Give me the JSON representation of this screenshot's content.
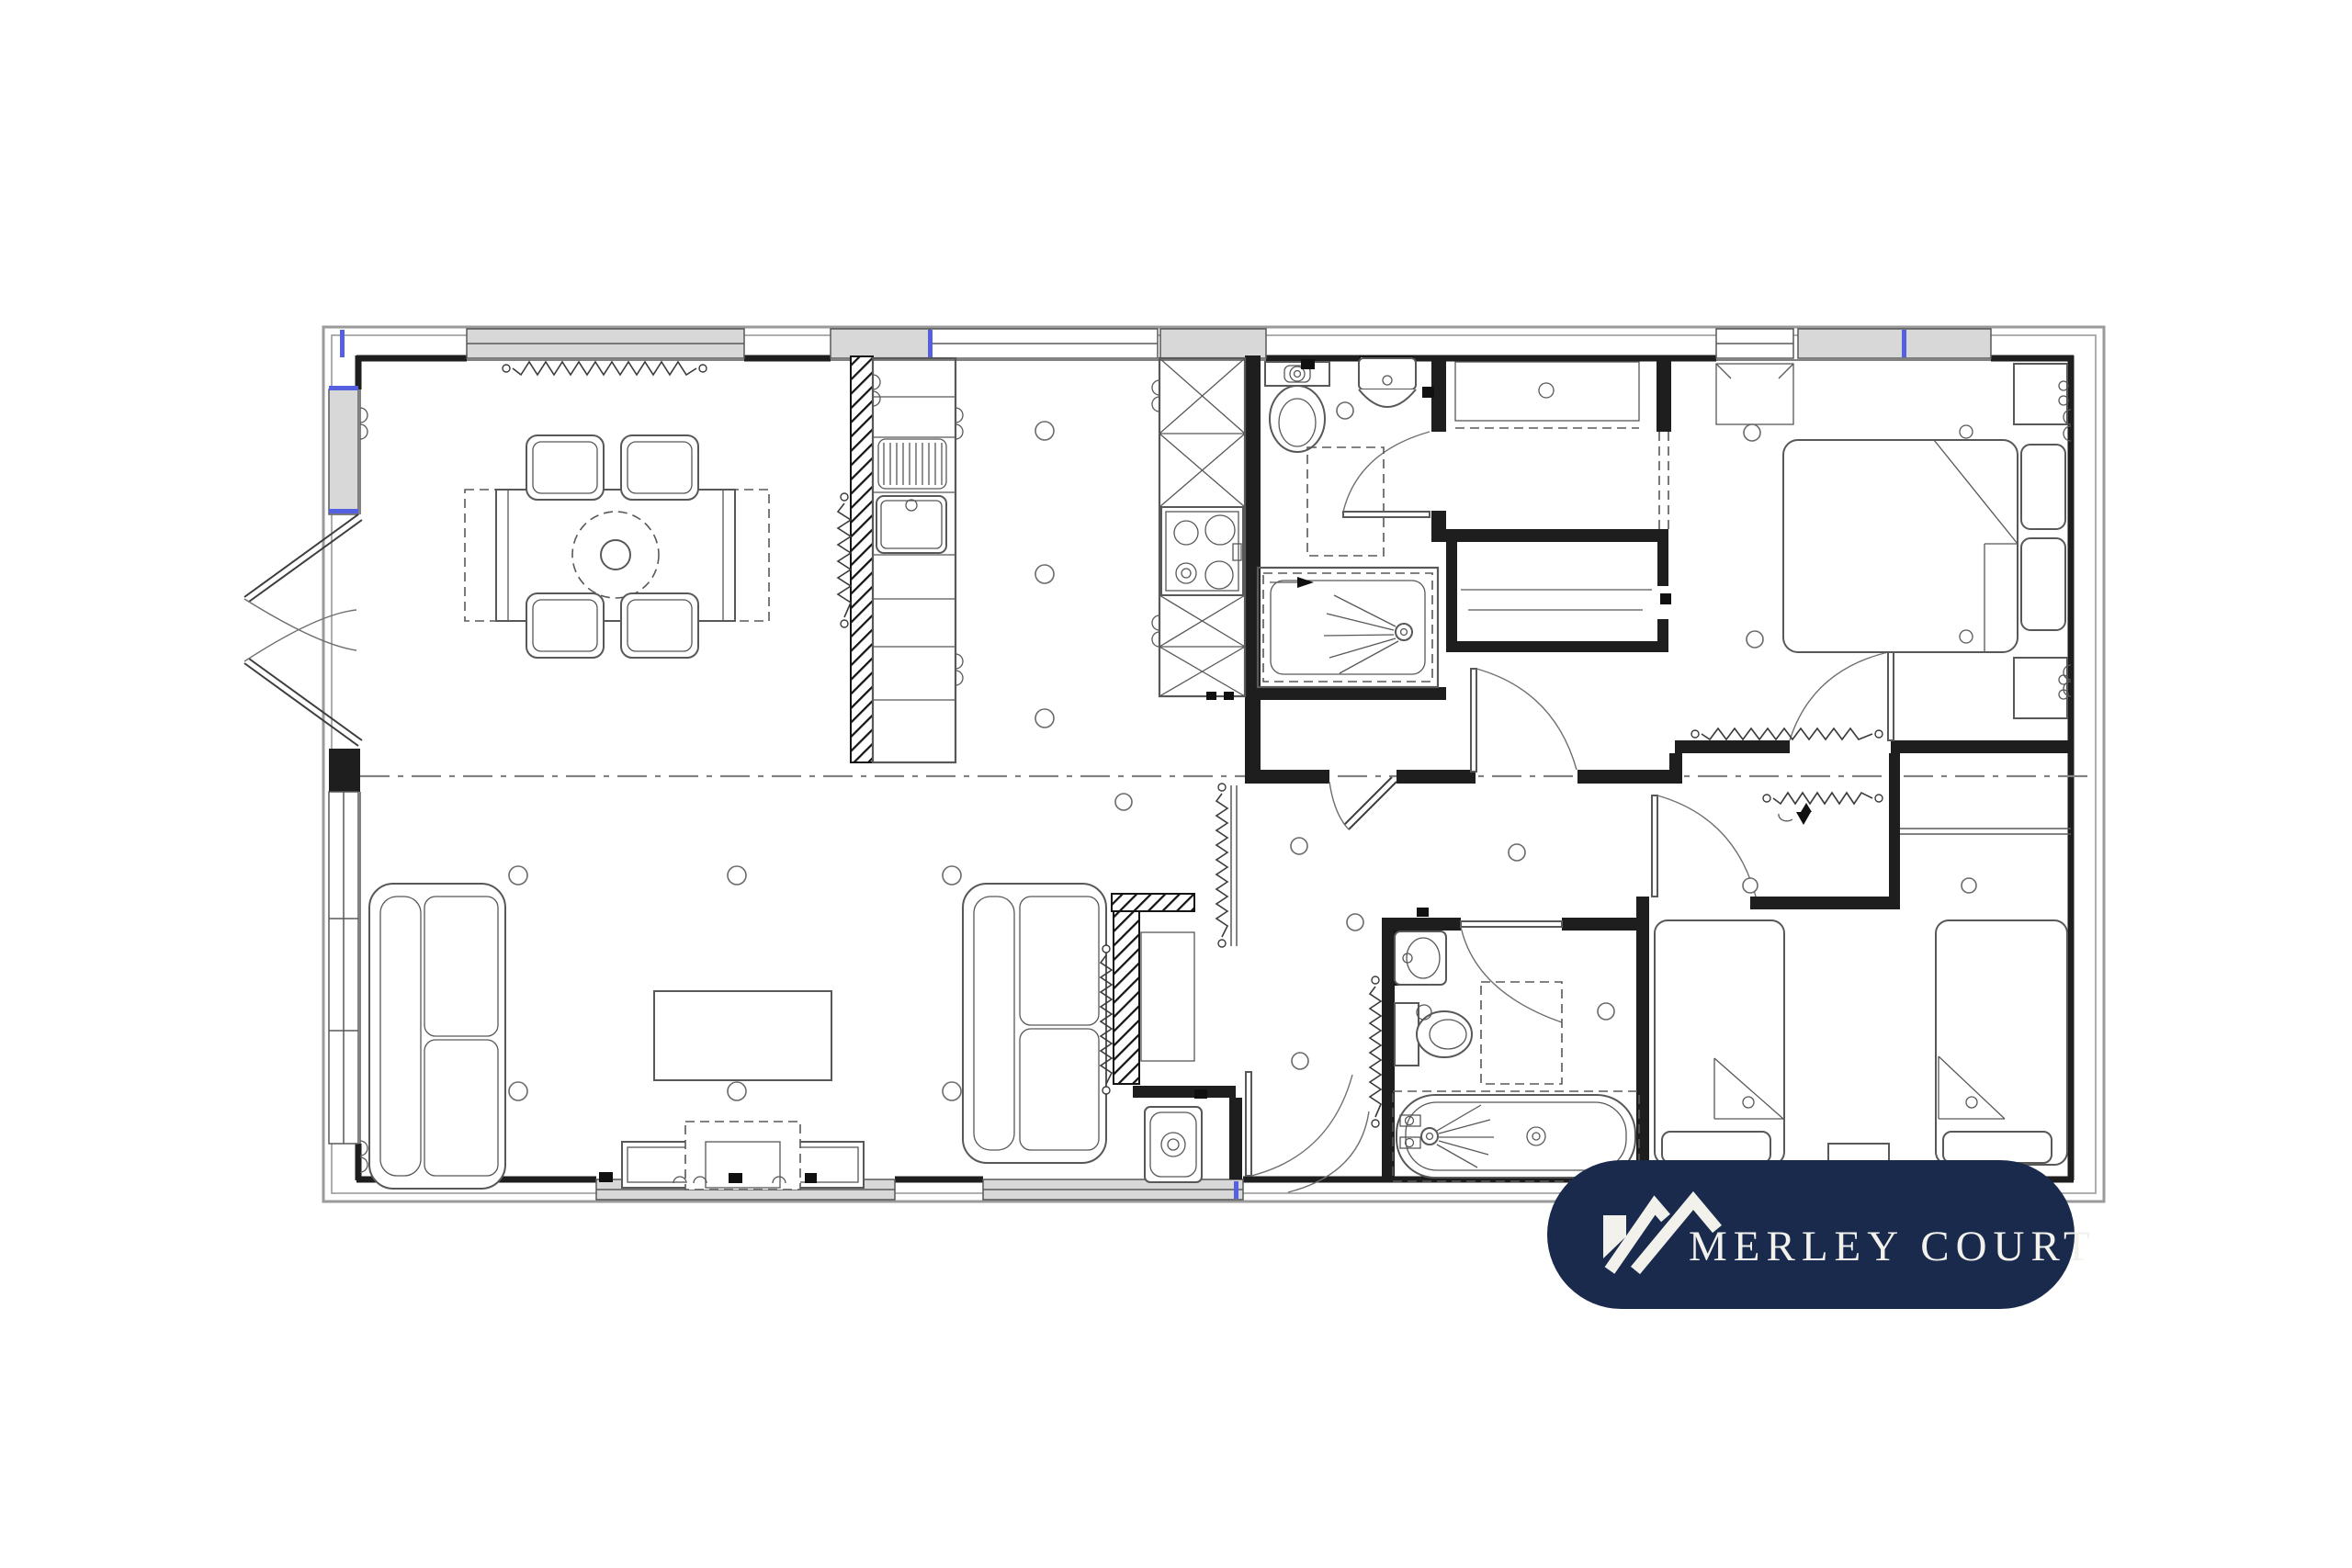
{
  "page": {
    "background": "#ffffff"
  },
  "palette": {
    "page_bg": "#ffffff",
    "wall": "#1e1e1e",
    "line": "#585858",
    "light_line": "#9a9a9a",
    "window_fill": "#d8d8d8",
    "dashdot": "#828282",
    "glazing_accent": "#5560e0",
    "radiator": "#3a3a3a",
    "logo_bg": "#1a2a4c",
    "logo_text": "#f2f1ec"
  },
  "logo": {
    "label": "MERLEY COURT",
    "icon": "mountain-roof-icon"
  },
  "plan": {
    "type": "floor-plan",
    "areas": [
      "dining-area",
      "kitchen",
      "shower-room",
      "wardrobe",
      "dressing-cupboard",
      "master-bedroom",
      "hallway",
      "living-room",
      "family-bathroom",
      "utility-cupboard",
      "twin-bedroom"
    ],
    "fixtures": [
      "dining-table",
      "dining-chairs-x4",
      "draining-board",
      "kitchen-sink",
      "hob",
      "tall-units",
      "sofa-x2",
      "coffee-table",
      "tv-unit",
      "double-bed",
      "bedside-cabinets-x2",
      "single-beds-x2",
      "toilets-x2",
      "basins-x2",
      "shower-enclosure",
      "bathtub",
      "washing-machine",
      "french-doors",
      "entrance-door",
      "radiators-x7",
      "downlights-x20"
    ]
  }
}
